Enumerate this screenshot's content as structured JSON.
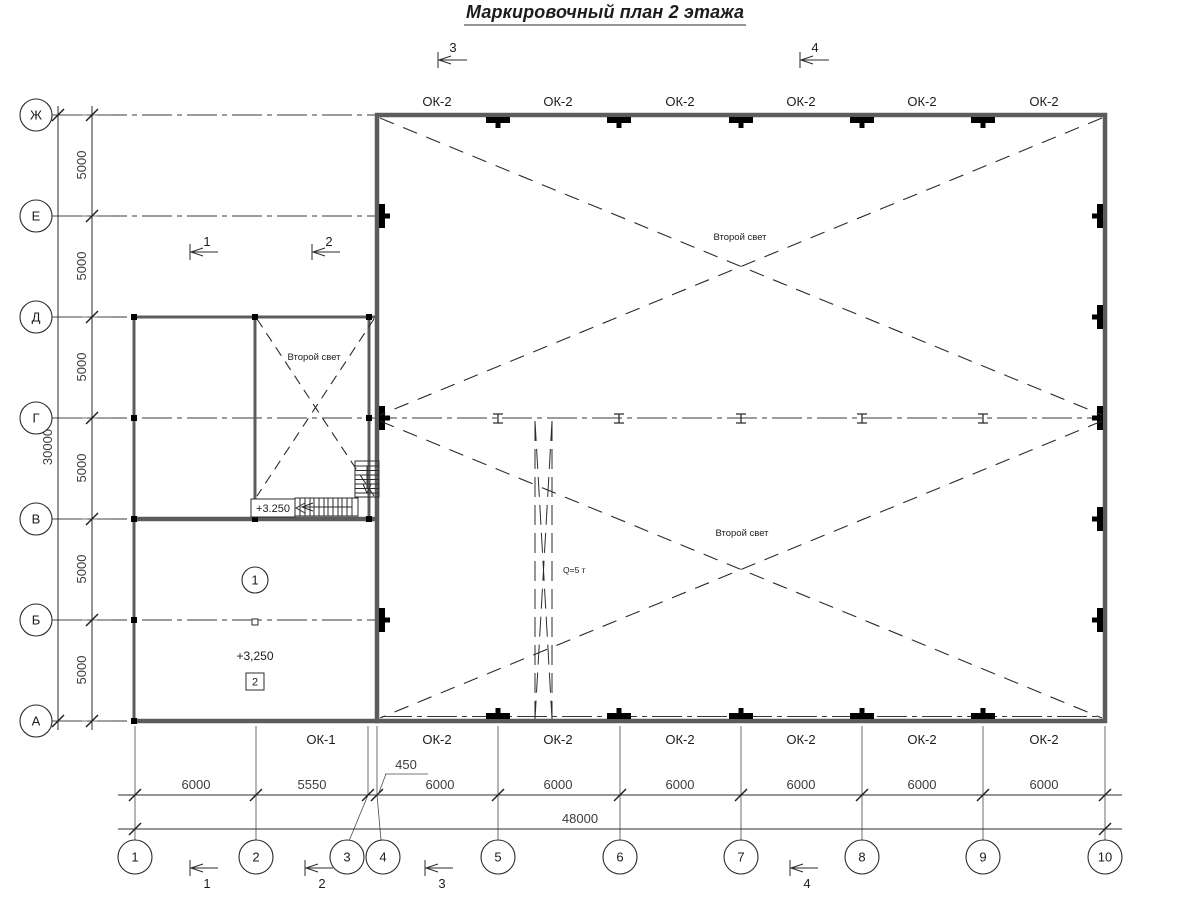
{
  "title": "Маркировочный план 2 этажа",
  "axes": {
    "rows": [
      "Ж",
      "Е",
      "Д",
      "Г",
      "В",
      "Б",
      "А"
    ],
    "cols": [
      "1",
      "2",
      "3",
      "4",
      "5",
      "6",
      "7",
      "8",
      "9",
      "10"
    ]
  },
  "dim_left": {
    "segments": [
      "5000",
      "5000",
      "5000",
      "5000",
      "5000",
      "5000"
    ],
    "total": "30000"
  },
  "dim_bottom": {
    "segments": [
      "6000",
      "5550",
      "450",
      "6000",
      "6000",
      "6000",
      "6000",
      "6000",
      "6000"
    ],
    "total": "48000"
  },
  "windows_top": [
    "ОК-2",
    "ОК-2",
    "ОК-2",
    "ОК-2",
    "ОК-2",
    "ОК-2"
  ],
  "windows_bottom": [
    "ОК-1",
    "ОК-2",
    "ОК-2",
    "ОК-2",
    "ОК-2",
    "ОК-2",
    "ОК-2"
  ],
  "annotations": {
    "second_light_room": "Второй свет",
    "second_light_hall_top": "Второй свет",
    "second_light_hall_bottom": "Второй свет",
    "crane_capacity": "Q=5 т",
    "stair_level": "+3.250",
    "room_level": "+3,250",
    "room_marker": "1",
    "room_number": "2"
  },
  "section_marks": {
    "top": [
      "3",
      "4"
    ],
    "middle": [
      "1",
      "2"
    ],
    "bottom": [
      "1",
      "2",
      "3",
      "4"
    ]
  }
}
